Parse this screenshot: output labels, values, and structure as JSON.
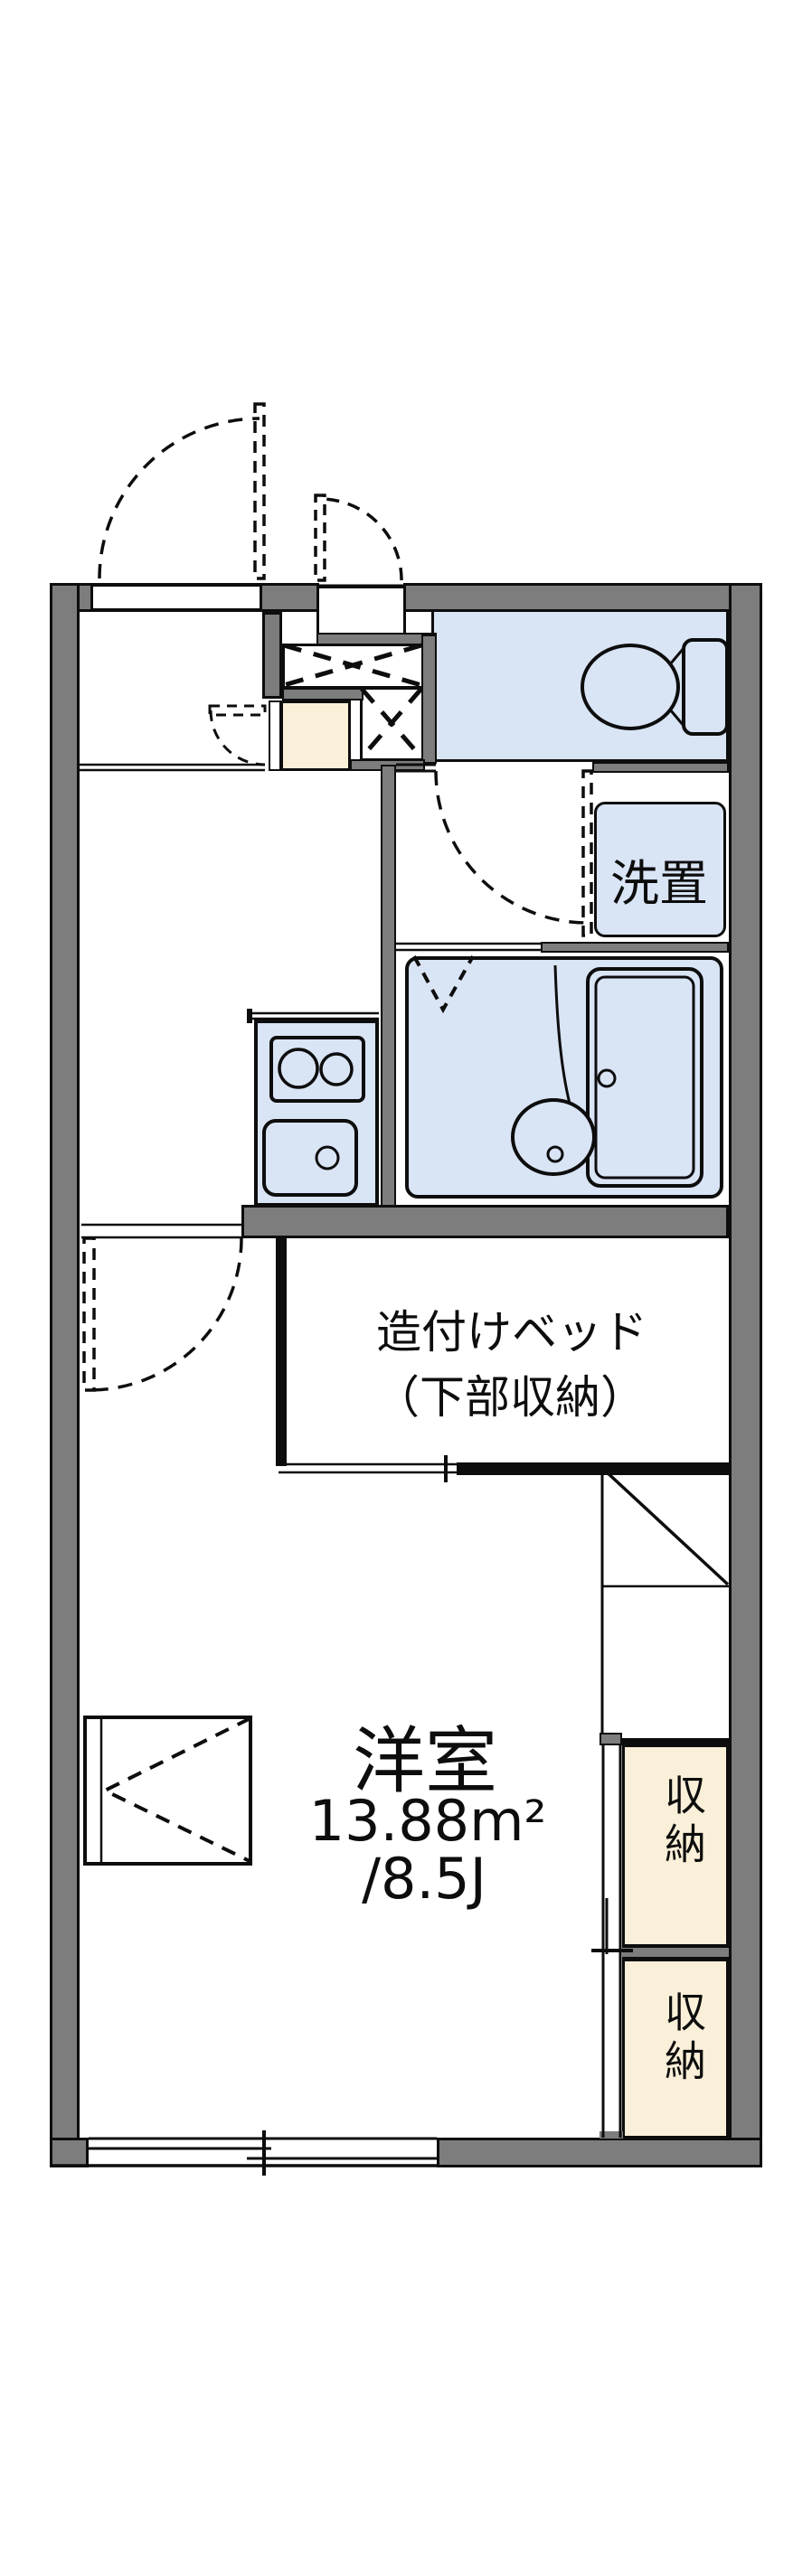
{
  "document": {
    "type": "japanese-apartment-floorplan",
    "labels": {
      "built_in_bed_line1": "造付けベッド",
      "built_in_bed_line2": "（下部収納）",
      "washer_place": "洗置",
      "main_room_name": "洋室",
      "main_room_area_m2": "13.88m²",
      "main_room_area_tatami": "/8.5J",
      "storage_upper": "収納",
      "storage_lower": "収納"
    },
    "colors": {
      "wall": "#7d7d7d",
      "room_blue": "#d9e4f5",
      "storage_cream": "#faefd8",
      "line": "#0d0d0d"
    }
  }
}
